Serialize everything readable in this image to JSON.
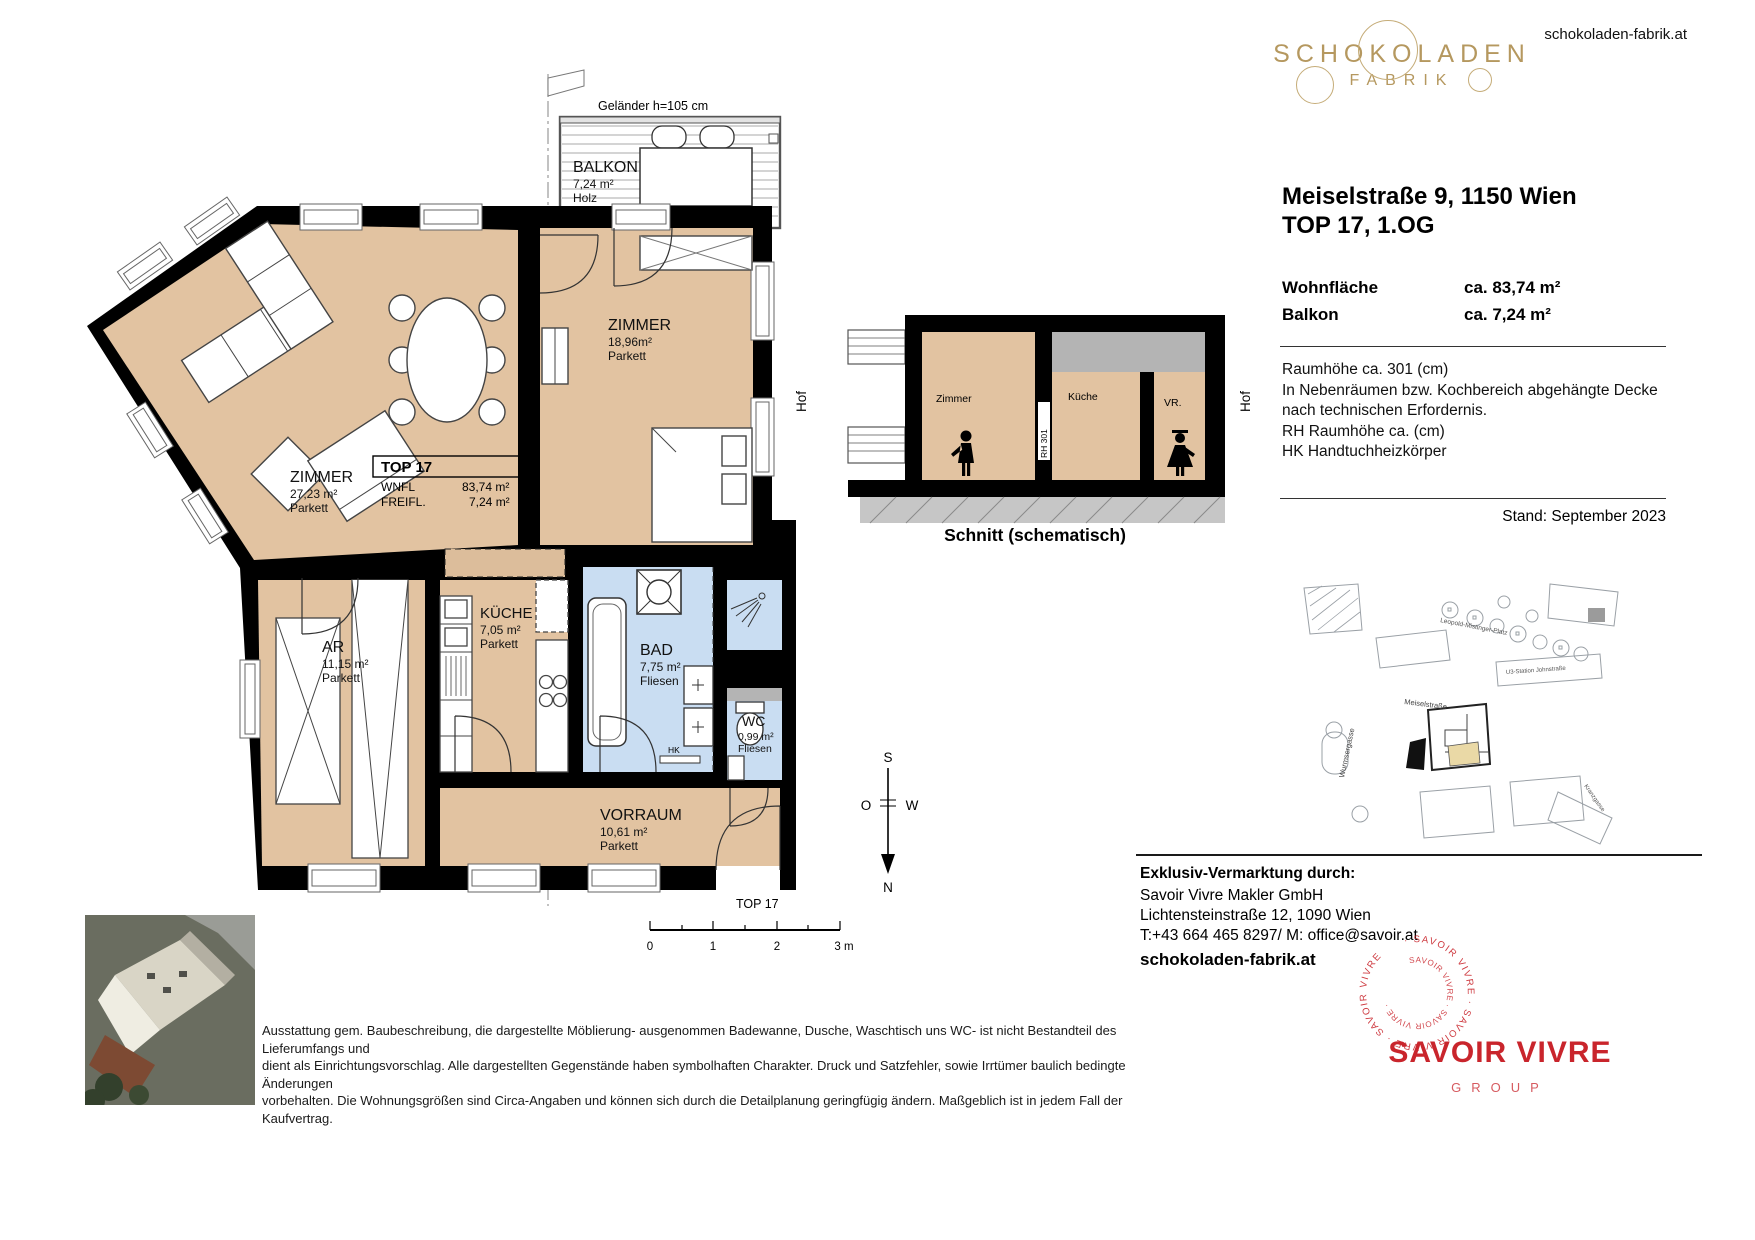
{
  "header": {
    "website": "schokoladen-fabrik.at",
    "logo_line1": "SCHOKOLADEN",
    "logo_line2": "FABRIK"
  },
  "property": {
    "title_line1": "Meiselstraße 9, 1150 Wien",
    "title_line2": "TOP 17, 1.OG",
    "areas": [
      {
        "label": "Wohnfläche",
        "value": "ca. 83,74 m²"
      },
      {
        "label": "Balkon",
        "value": "ca. 7,24 m²"
      }
    ],
    "notes": [
      "Raumhöhe ca. 301 (cm)",
      "In Nebenräumen bzw. Kochbereich abgehängte Decke",
      "nach technischen Erfordernis.",
      "RH Raumhöhe ca. (cm)",
      "HK Handtuchheizkörper"
    ],
    "stand": "Stand: September 2023"
  },
  "floorplan": {
    "balcony_note": "Geländer h=105 cm",
    "rooms": [
      {
        "name": "BALKON",
        "area": "7,24 m²",
        "floor": "Holz"
      },
      {
        "name": "ZIMMER",
        "area": "18,96m²",
        "floor": "Parkett"
      },
      {
        "name": "ZIMMER",
        "area": "27,23 m²",
        "floor": "Parkett"
      },
      {
        "name": "AR",
        "area": "11,15 m²",
        "floor": "Parkett"
      },
      {
        "name": "KÜCHE",
        "area": "7,05 m²",
        "floor": "Parkett"
      },
      {
        "name": "BAD",
        "area": "7,75 m²",
        "floor": "Fliesen"
      },
      {
        "name": "WC",
        "area": "0,99 m²",
        "floor": "Fliesen"
      },
      {
        "name": "VORRAUM",
        "area": "10,61 m²",
        "floor": "Parkett"
      }
    ],
    "top_box": {
      "title": "TOP 17",
      "rows": [
        {
          "label": "WNFL",
          "value": "83,74 m²"
        },
        {
          "label": "FREIFL.",
          "value": "7,24 m²"
        }
      ]
    },
    "hof_left": "Hof",
    "hof_right": "Hof",
    "hk_label": "HK",
    "entrance_label": "TOP 17",
    "compass": {
      "top": "S",
      "left": "O",
      "right": "W",
      "bottom": "N"
    },
    "scale_labels": [
      "0",
      "1",
      "2",
      "3 m"
    ]
  },
  "section": {
    "caption": "Schnitt (schematisch)",
    "room_labels": [
      "Zimmer",
      "Küche",
      "VR."
    ],
    "rh_label": "RH 301"
  },
  "map": {
    "streets": [
      "Leopold-Mistinger-Platz",
      "Meiselstraße",
      "Wurmsergasse",
      "U3-Station Johnstraße",
      "Kranzgasse"
    ]
  },
  "footer": {
    "marketing_heading": "Exklusiv-Vermarktung durch:",
    "company": "Savoir Vivre Makler GmbH",
    "address": "Lichtensteinstraße 12, 1090 Wien",
    "contact": "T:+43 664 465 8297/ M: office@savoir.at",
    "website": "schokoladen-fabrik.at",
    "brand": "SAVOIR VIVRE",
    "brand_sub": "GROUP",
    "stamp_ring": "· SAVOIR VIVRE · SAVOIR VIVRE · SAVOIR VIVRE ",
    "stamp_inner": "SAVOIR VIVRE · SAVOIR VIVRE ·",
    "disclaimer": [
      "Ausstattung gem. Baubeschreibung, die dargestellte Möblierung- ausgenommen Badewanne, Dusche, Waschtisch uns WC- ist nicht Bestandteil des Lieferumfangs und",
      "dient als Einrichtungsvorschlag. Alle dargestellten Gegenstände haben symbolhaften Charakter. Druck und Satzfehler, sowie Irrtümer baulich bedingte Änderungen",
      "vorbehalten. Die Wohnungsgrößen sind Circa-Angaben und können sich durch die Detailplanung geringfügig ändern. Maßgeblich ist in jedem Fall der Kaufvertrag."
    ]
  },
  "colors": {
    "room_beige": "#e2c3a1",
    "wet_blue": "#c9ddf2",
    "brand_gold": "#b5985f",
    "brand_red": "#c9252c",
    "decke_gray": "#b4b4b4"
  }
}
